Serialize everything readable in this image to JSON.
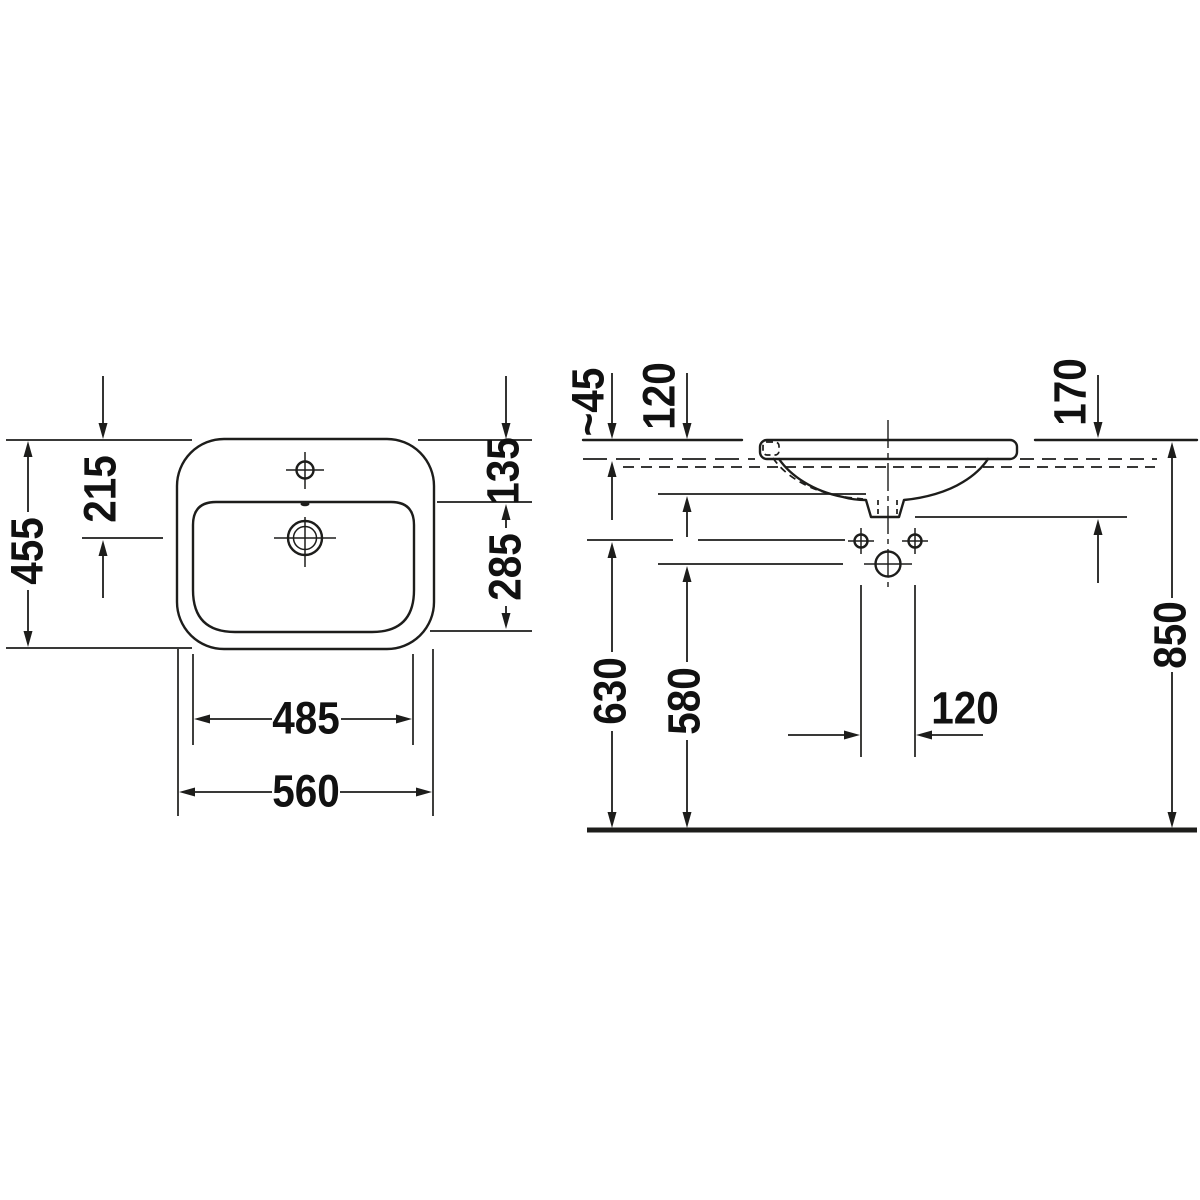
{
  "drawing": {
    "kind": "washbasin-technical-drawing",
    "style": {
      "line_color": "#1d1d1b",
      "background_color": "#ffffff"
    }
  },
  "plan": {
    "overall_width": "560",
    "bowl_width": "485",
    "overall_depth": "455",
    "top_edge_to_drain": "215",
    "top_edge_to_bowl": "135",
    "bowl_depth": "285"
  },
  "section": {
    "counter_thickness": "~45",
    "counter_to_underside": "120",
    "counter_to_outlet": "170",
    "floor_to_fixing_holes": "630",
    "floor_to_outlet": "580",
    "floor_to_rim": "850",
    "fixing_hole_spacing": "120"
  }
}
